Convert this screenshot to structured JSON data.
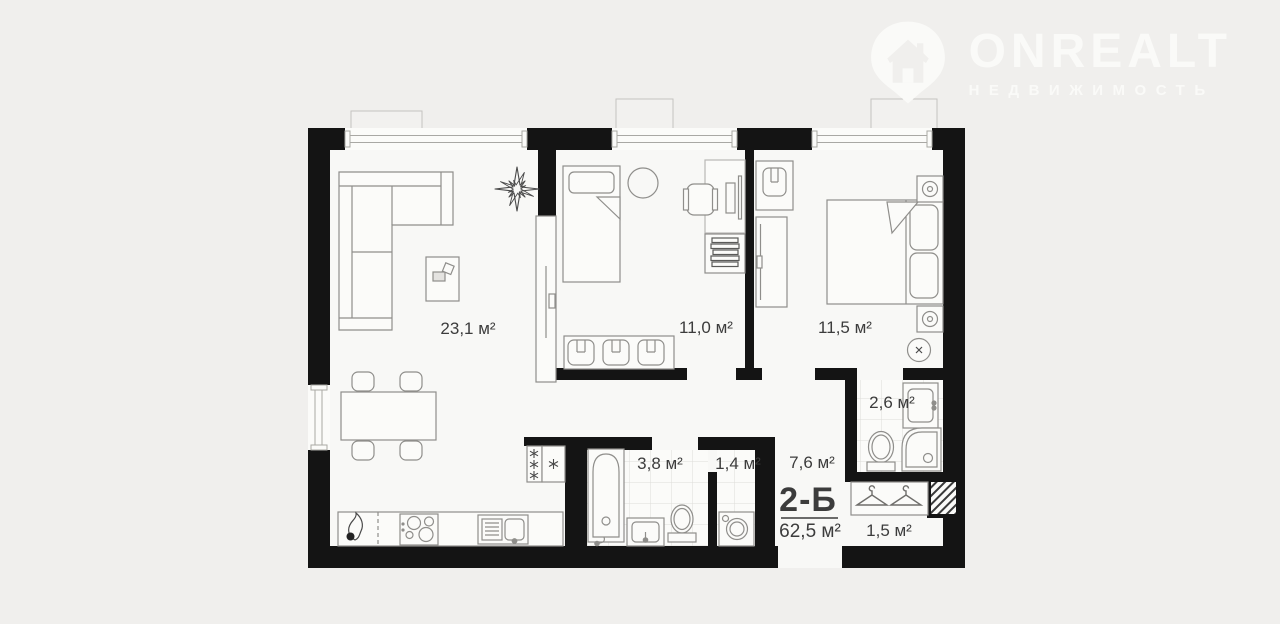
{
  "logo": {
    "brand": "ONREALT",
    "tagline": "НЕДВИЖИМОСТЬ"
  },
  "unit": {
    "name": "2-Б",
    "total_area": "62,5 м²"
  },
  "rooms": {
    "living": "23,1 м²",
    "bedroom1": "11,0 м²",
    "bedroom2": "11,5 м²",
    "bathroom_ensuite": "2,6 м²",
    "bathroom": "3,8 м²",
    "wc": "1,4 м²",
    "hallway": "7,6 м²",
    "wardrobe": "1,5 м²"
  },
  "colors": {
    "background": "#f0efed",
    "wall": "#141414",
    "floor": "#f8f8f6",
    "furniture_line": "#8f8e8b",
    "label_text": "#3c3c3c",
    "logo": "#fafaf8"
  }
}
